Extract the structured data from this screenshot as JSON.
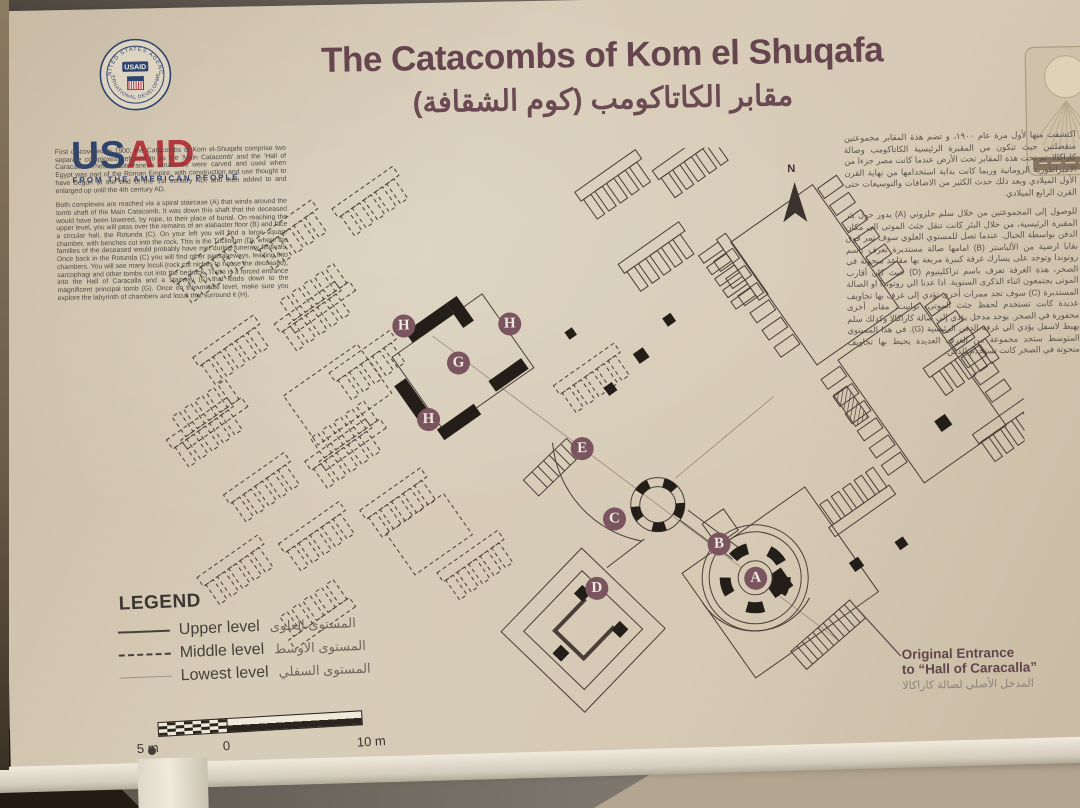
{
  "sign": {
    "title_en": "The Catacombs of Kom el Shuqafa",
    "title_ar": "مقابر الكاتاكومب (كوم الشقافة)",
    "usaid": {
      "seal_top_text": "UNITED STATES AGENCY",
      "seal_bottom_text": "INTERNATIONAL DEVELOPMENT",
      "seal_center": "USAID",
      "wordmark_us": "US",
      "wordmark_aid": "AID",
      "tagline": "FROM THE AMERICAN PEOPLE",
      "navy": "#2e4470",
      "red": "#b5383f"
    },
    "colors": {
      "board_beige": "#d6cab5",
      "title_maroon": "#66454f",
      "marker_maroon": "#7a5560",
      "map_line": "#4a3e38"
    },
    "intro_en": {
      "para1": "First discovered in 1900, the Catacombs of Kom el-Shuqafa comprise two separate complexes, referred to as the 'Main Catacomb' and the 'Hall of Caracalla'. These subterranean structures were carved and used when Egypt was part of the Roman Empire, with construction and use thought to have begun at the end of the 1st century AD, and then added to and enlarged up until the 4th century AD.",
      "para2": "Both complexes are reached via a spiral staircase (A) that winds around the tomb shaft of the Main Catacomb. It was down this shaft that the deceased would have been lowered, by rope, to their place of burial. On reaching the upper level, you will pass over the remains of an alabaster floor (B) and face a circular hall, the Rotunda (C). On your left you will find a large square chamber, with benches cut into the rock. This is the Triclinium (D), where the families of the deceased would probably have met during funerary festivals. Once back in the Rotunda (C) you will find other passageways, leading into chambers. You will see many loculi (rock cut niches to house the deceased), sarcophagi and other tombs cut into the bedrock. There is a forced entrance into the Hall of Caracalla and a stairway (E) that leads down to the magnificent principal tomb (G). Once on this middle level, make sure you explore the labyrinth of chambers and loculi that surround it (H)."
    },
    "intro_ar": {
      "para1": "اكتشفت منها لأول مرة عام ١٩٠٠، و تضم هذة المقابر مجموعتين منفصلتين حيث تتكون من المقبرة الرئيسية الكاتاكومب وصالة كاراكالا. تم نحت هذة المقابر تحت الأرض عندما كانت مصر جزءا من الامبراطورية الرومانية وربما كانت بداية استخدامها من نهاية القرن الأول الميلادي وبعد ذلك حدث الكثير من الاضافات والتوسيعات حتى القرن الرابع الميلادي.",
      "para2": "للوصول إلى المجموعتين من خلال سلم حلزوني (A) يدور حول بئر المقبرة الرئيسية، من خلال البئر كانت تنقل جثث الموتى الى مكان الدفن بواسطة الحبال. عندما تصل للمستوي العلوي سوف تمر فوق بقايا ارضية من الألباستر (B) امامها صالة مستديرة تعرف باسم روتوندا وتوجد على يسارك غرفة كبيرة مربعة بها مقاعد منحوتة في الصخر، هذة الغرفة تعرف باسم تراكلينيوم (D) حيث كان أقارب الموتى يجتمعون اثناء الذكرى السنوية. اذا عدنا الي روتوندا او الصالة المستديرة (C) سوف تجد ممرات أخرى تؤدي إلى غرف بها تجاويف عديدة كانت تستخدم لحفظ جثث الموتى، توابيت، مقابر أخرى محفورة في الصخر. يوجد مدخل يؤدي إلى صالة كاراكالا وكذلك سلم يهبط لاسفل يؤدي الي غرفة الدفن الرئيسية (G). في هذا المستوي المتوسط ستجد مجموعة من الغرف العديدة يحيط بها تجاويف منحوتة في الصخر كانت تستخدم للدفن."
    },
    "legend": {
      "heading": "LEGEND",
      "items": [
        {
          "label_en": "Upper level",
          "label_ar": "المستوى العلوى",
          "style": "solid"
        },
        {
          "label_en": "Middle level",
          "label_ar": "المستوى الاوسط",
          "style": "dashed"
        },
        {
          "label_en": "Lowest level",
          "label_ar": "المستوى السفلي",
          "style": "thin"
        }
      ]
    },
    "scale_bar": {
      "left_label": "5 m",
      "mid_label": "0",
      "right_label": "10 m"
    },
    "map": {
      "north_label": "N",
      "markers": [
        {
          "label": "A"
        },
        {
          "label": "B"
        },
        {
          "label": "C"
        },
        {
          "label": "D"
        },
        {
          "label": "E"
        },
        {
          "label": "G"
        },
        {
          "label": "H"
        },
        {
          "label": "H"
        },
        {
          "label": "H"
        }
      ],
      "entrance_note_line1": "Original Entrance",
      "entrance_note_line2": "to “Hall of Caracalla”",
      "entrance_note_ar": "المدخل الأصلي لصالة كاراكالا"
    }
  }
}
